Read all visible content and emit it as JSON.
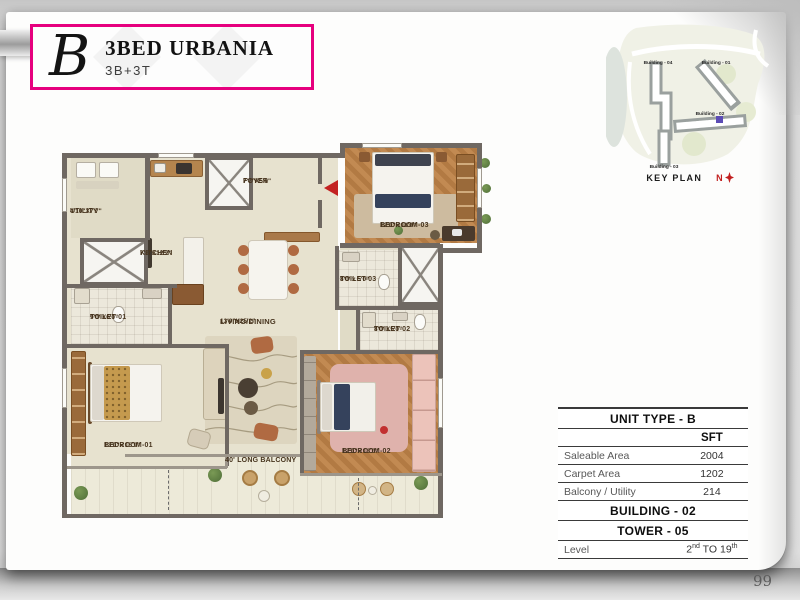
{
  "page": {
    "number": "99"
  },
  "header": {
    "logo_letter": "B",
    "title": "3BED URBANIA",
    "subtitle": "3B+3T"
  },
  "key_plan": {
    "label": "KEY PLAN",
    "north_label": "N",
    "buildings": [
      {
        "name": "Building - 04"
      },
      {
        "name": "Building - 01"
      },
      {
        "name": "Building - 02"
      },
      {
        "name": "Building - 03"
      }
    ],
    "highlight_color": "#5b4bb5"
  },
  "floor_plan": {
    "rooms": [
      {
        "id": "utility",
        "name": "UTILITY",
        "dims": "4'10\"X7'7\""
      },
      {
        "id": "kitchen",
        "name": "KITCHEN",
        "dims": "7'8\"X12'2\""
      },
      {
        "id": "toilet-01",
        "name": "TOILET-01",
        "dims": "9'0\"X6'0\""
      },
      {
        "id": "foyer",
        "name": "FOYER",
        "dims": "7'7\"X5'0\""
      },
      {
        "id": "living-dining",
        "name": "LIVING/DINING",
        "dims": "13'0\"X25'2\""
      },
      {
        "id": "bedroom-03",
        "name": "BEDROOM-03",
        "dims": "12'0\"x 11'0\""
      },
      {
        "id": "toilet-03",
        "name": "TOILET-03",
        "dims": "8'0\"x 5'0\""
      },
      {
        "id": "toilet-02",
        "name": "TOILET-02",
        "dims": "8'0\"X5'0\""
      },
      {
        "id": "bedroom-01",
        "name": "BEDROOM-01",
        "dims": "13'0\"x 15'9\""
      },
      {
        "id": "bedroom-02",
        "name": "BEDROOM-02",
        "dims": "12'0\"x 13'0\""
      },
      {
        "id": "balcony",
        "name": "40' LONG BALCONY",
        "dims": ""
      }
    ]
  },
  "info_table": {
    "title": "UNIT TYPE - B",
    "unit_header": "SFT",
    "rows": [
      {
        "label": "Saleable Area",
        "value": "2004"
      },
      {
        "label": "Carpet Area",
        "value": "1202"
      },
      {
        "label": "Balcony / Utility",
        "value": "214"
      }
    ],
    "building": "BUILDING - 02",
    "tower": "TOWER - 05",
    "level": {
      "label": "Level",
      "base": "2",
      "sup1": "nd",
      "mid": " TO 19",
      "sup2": "th"
    }
  },
  "colors": {
    "accent_magenta": "#e6007e",
    "north_red": "#c21f1f",
    "wall": "#6f6862"
  }
}
